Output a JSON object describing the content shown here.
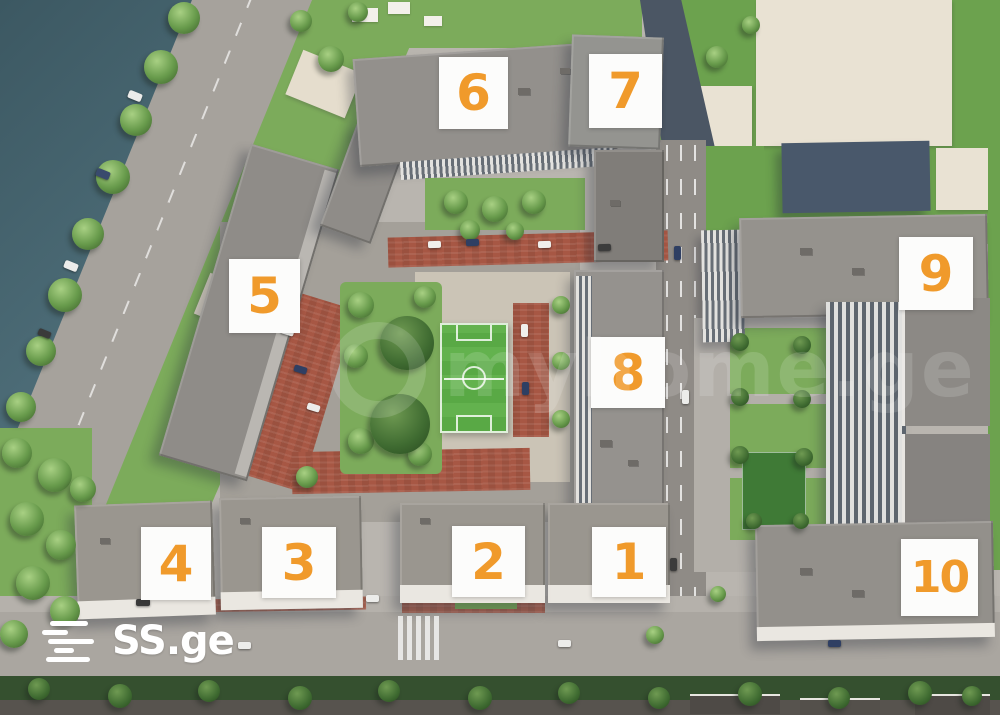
{
  "building_labels": [
    {
      "text": "1"
    },
    {
      "text": "2"
    },
    {
      "text": "3"
    },
    {
      "text": "4"
    },
    {
      "text": "5"
    },
    {
      "text": "6"
    },
    {
      "text": "7"
    },
    {
      "text": "8"
    },
    {
      "text": "9"
    },
    {
      "text": "10"
    }
  ],
  "logo": {
    "text": "SS.ge"
  },
  "watermark": {
    "text": "myhome.ge"
  },
  "colors": {
    "label_number": "#F09A2B",
    "label_background": "#FFFFFF",
    "water": "#42606B",
    "grass": "#78A859",
    "pitch_green": "#5FAE47",
    "brick_red": "#A75744",
    "road_gray": "#A5A19B",
    "logo_white": "#FFFFFF"
  }
}
